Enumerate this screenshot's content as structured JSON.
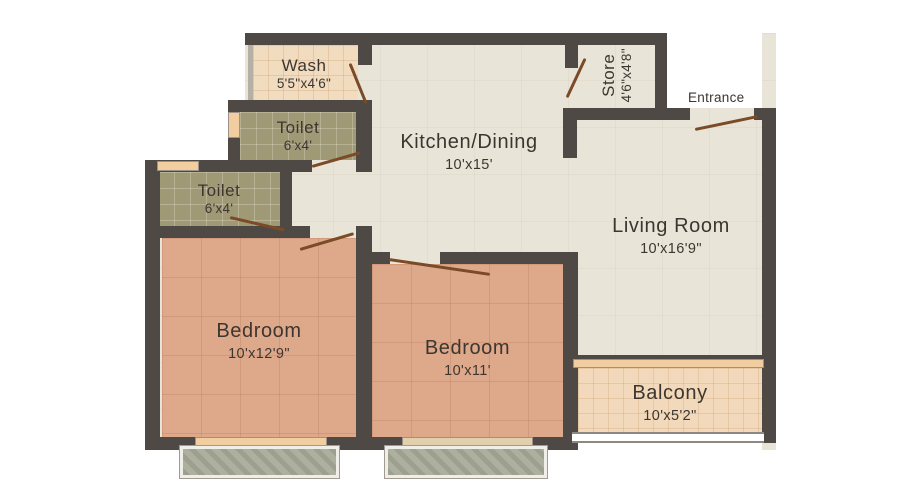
{
  "rooms": {
    "wash": {
      "name": "Wash",
      "dims": "5'5\"x4'6\""
    },
    "toilet_upper": {
      "name": "Toilet",
      "dims": "6'x4'"
    },
    "toilet_lower": {
      "name": "Toilet",
      "dims": "6'x4'"
    },
    "kitchen_dining": {
      "name": "Kitchen/Dining",
      "dims": "10'x15'"
    },
    "store": {
      "name": "Store",
      "dims": "4'6\"x4'8\""
    },
    "living_room": {
      "name": "Living Room",
      "dims": "10'x16'9\""
    },
    "bedroom_left": {
      "name": "Bedroom",
      "dims": "10'x12'9\""
    },
    "bedroom_middle": {
      "name": "Bedroom",
      "dims": "10'x11'"
    },
    "balcony": {
      "name": "Balcony",
      "dims": "10'x5'2\""
    }
  },
  "labels": {
    "entrance": "Entrance"
  },
  "colors": {
    "wall": "#4e4944",
    "floor_base": "#e9e4d8",
    "bedroom_floor": "#dea88a",
    "toilet_floor": "#9f9976",
    "wash_floor": "#f1dcc0",
    "balcony_floor": "#f2d9bb",
    "planter": "#a8ab98",
    "door": "#7b4b27",
    "window": "#f2cda0",
    "text": "#3d3630"
  }
}
